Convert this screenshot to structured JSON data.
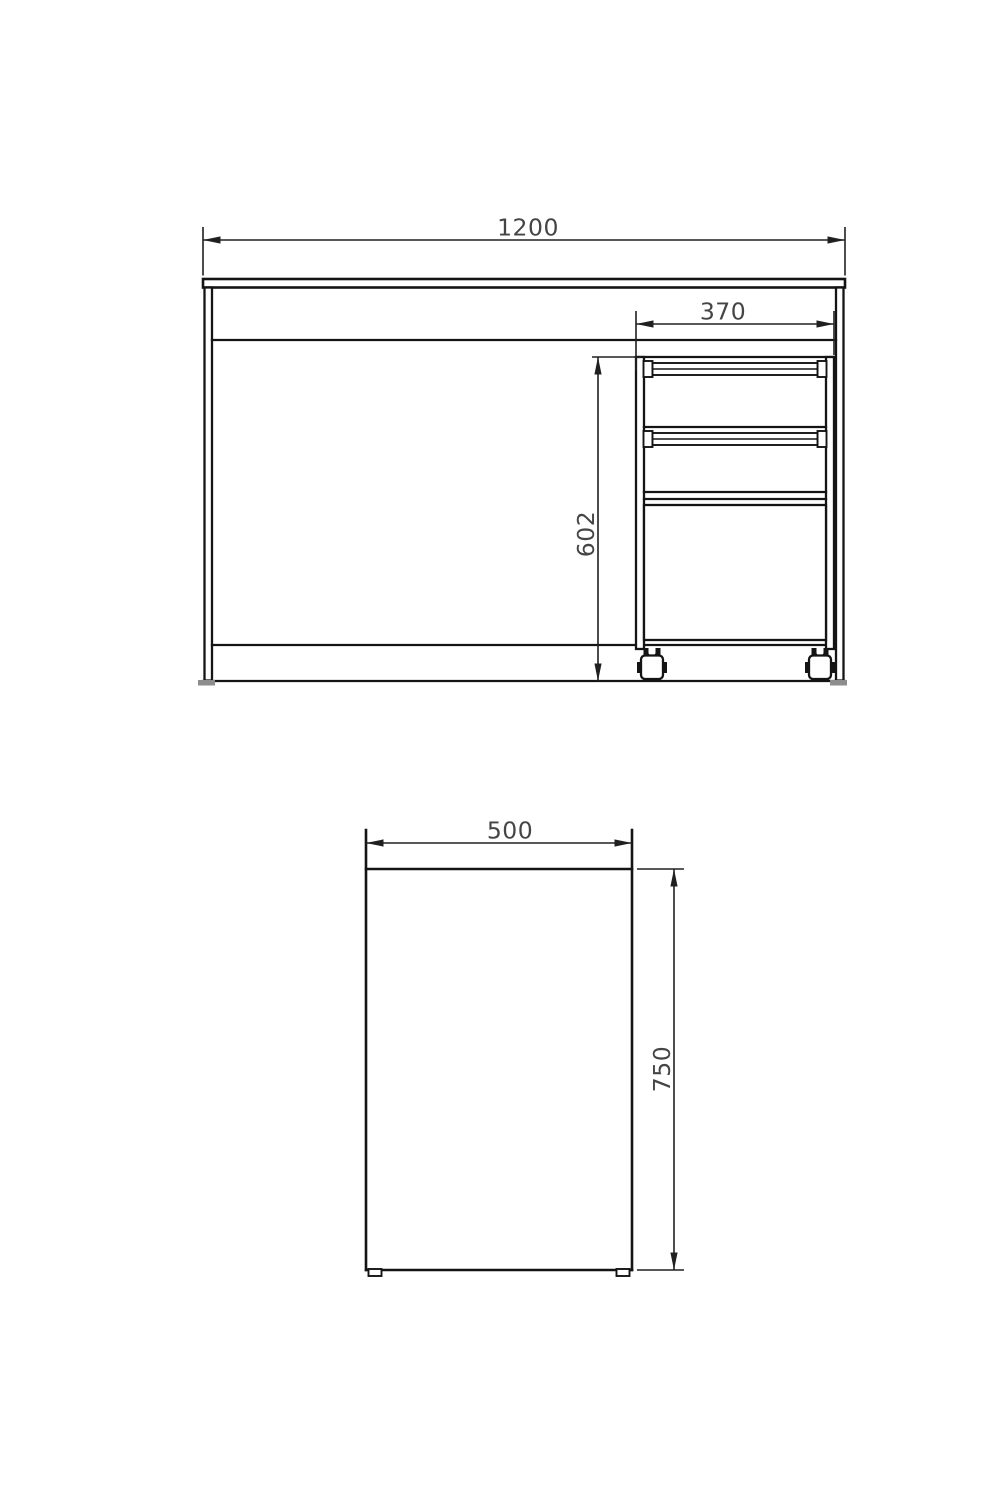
{
  "colors": {
    "background": "#ffffff",
    "object_line": "#141414",
    "dimension_line": "#202020",
    "dimension_text": "#454545",
    "desk_foot_fill": "#8d8d8d"
  },
  "front_view": {
    "overall_width_label": "1200",
    "pedestal_width_label": "370",
    "pedestal_height_label": "602"
  },
  "side_view": {
    "depth_label": "500",
    "height_label": "750"
  }
}
